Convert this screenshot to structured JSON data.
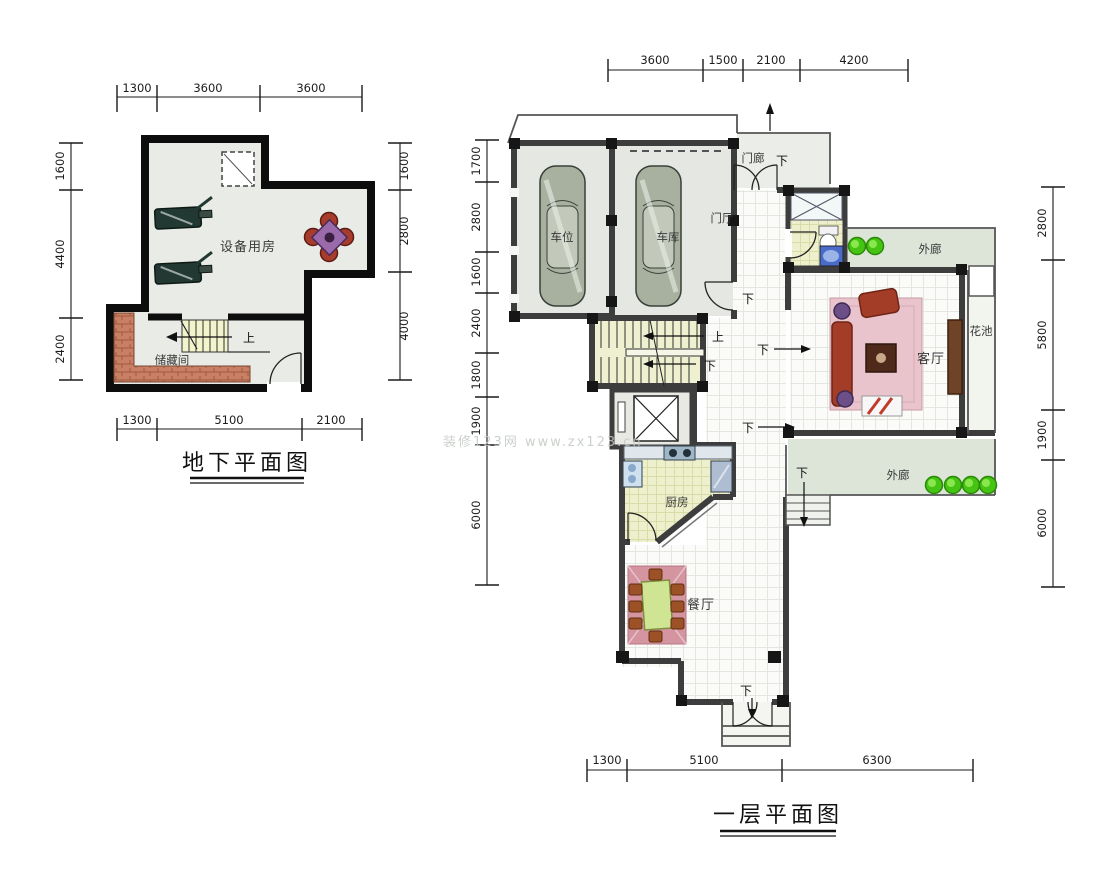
{
  "watermark": "装修123网 www.zx123.cn",
  "basement": {
    "title": "地下平面图",
    "dims": {
      "top": [
        "1300",
        "3600",
        "3600"
      ],
      "left": [
        "1600",
        "4400",
        "2400"
      ],
      "right": [
        "1600",
        "2800",
        "4000"
      ],
      "bottom": [
        "1300",
        "5100",
        "2100"
      ]
    },
    "rooms": {
      "equipment": "设备用房",
      "storage": "储藏间"
    },
    "marks": {
      "up": "上"
    }
  },
  "first_floor": {
    "title": "一层平面图",
    "dims": {
      "top": [
        "3600",
        "1500",
        "2100",
        "4200"
      ],
      "left": [
        "1700",
        "2800",
        "1600",
        "2400",
        "1800",
        "1900",
        "6000"
      ],
      "right": [
        "2800",
        "5800",
        "1900",
        "6000"
      ],
      "bottom": [
        "1300",
        "5100",
        "6300"
      ]
    },
    "rooms": {
      "carport": "车位",
      "garage": "车库",
      "porch": "门廊",
      "foyer": "门厅",
      "veranda_top": "外廊",
      "veranda_bottom": "外廊",
      "flower_bed": "花池",
      "living": "客厅",
      "kitchen": "厨房",
      "dining": "餐厅"
    },
    "marks": {
      "up": "上",
      "down": "下"
    }
  }
}
